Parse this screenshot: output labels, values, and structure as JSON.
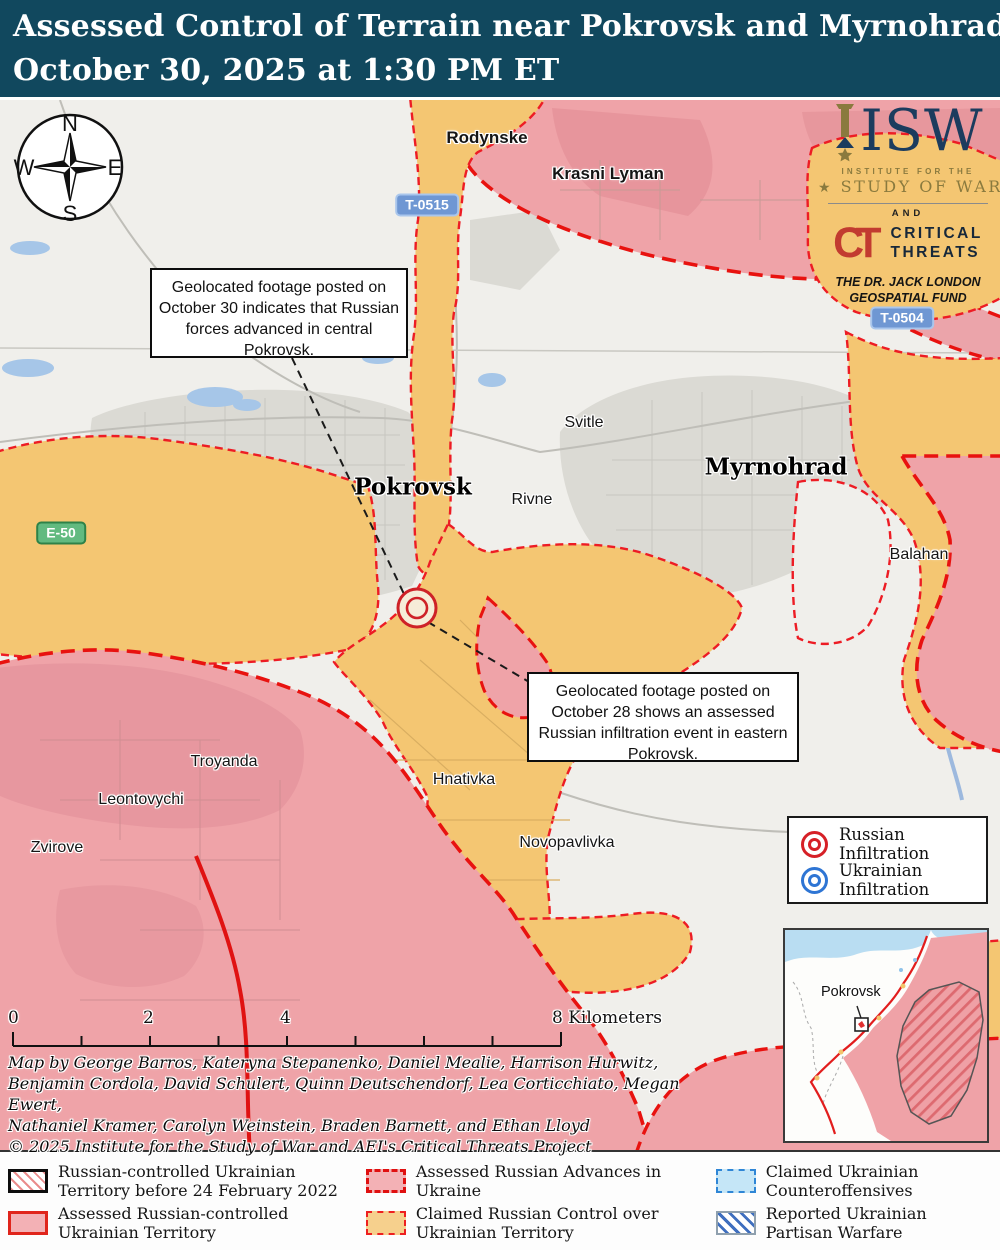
{
  "title": {
    "line1": "Assessed Control of Terrain near Pokrovsk and Myrnohrad",
    "line2": "October 30, 2025 at 1:30 PM ET"
  },
  "compass": {
    "n": "N",
    "e": "E",
    "s": "S",
    "w": "W"
  },
  "logo": {
    "isw": "ISW",
    "institute": "INSTITUTE FOR THE",
    "study": "STUDY OF WAR",
    "and": "AND",
    "ct": "CT",
    "critical": "CRITICAL",
    "threats": "THREATS",
    "fund_line1": "THE DR. JACK LONDON",
    "fund_line2": "GEOSPATIAL FUND"
  },
  "map": {
    "labels": {
      "rodynske": "Rodynske",
      "krasni_lyman": "Krasni Lyman",
      "svitle": "Svitle",
      "myrnohrad": "Myrnohrad",
      "pokrovsk": "Pokrovsk",
      "rivne": "Rivne",
      "balahan": "Balahan",
      "troyanda": "Troyanda",
      "leontovychi": "Leontovychi",
      "zvirove": "Zvirove",
      "hnativka": "Hnativka",
      "novopavlivka": "Novopavlivka"
    },
    "shields": {
      "t0515": "T-0515",
      "t0504": "T-0504",
      "e50": "E-50"
    },
    "callout1": "Geolocated footage posted on October 30 indicates that Russian forces advanced in central Pokrovsk.",
    "callout2": "Geolocated footage posted on October 28 shows an assessed Russian infiltration event in eastern Pokrovsk.",
    "infiltration_legend": {
      "russian": "Russian Infiltration",
      "ukrainian": "Ukrainian Infiltration"
    },
    "inset_label": "Pokrovsk",
    "scale": {
      "t0": "0",
      "t2": "2",
      "t4": "4",
      "t8": "8  Kilometers"
    },
    "credits": [
      "Map by George Barros, Kateryna Stepanenko, Daniel Mealie, Harrison Hurwitz,",
      "Benjamin Cordola, David Schulert, Quinn Deutschendorf, Lea Corticchiato, Megan Ewert,",
      "Nathaniel Kramer, Carolyn Weinstein, Braden Barnett, and Ethan Lloyd",
      "© 2025 Institute for the Study of War and AEI's Critical Threats Project"
    ]
  },
  "legend": {
    "items": [
      {
        "label": "Russian-controlled Ukrainian Territory before 24 February 2022"
      },
      {
        "label": "Assessed Russian-controlled Ukrainian Territory"
      },
      {
        "label": "Assessed Russian Advances in Ukraine"
      },
      {
        "label": "Claimed Russian Control over Ukrainian Territory"
      },
      {
        "label": "Claimed Ukrainian Counteroffensives"
      },
      {
        "label": "Reported Ukrainian Partisan Warfare"
      }
    ]
  },
  "colors": {
    "titlebar": "#11485e",
    "claimed_russian_yellow": "#f4c672",
    "assessed_russian_pink": "#efa3a8",
    "advance_dash_red": "#e8120f",
    "counteroffensive_blue": "#c5e6f7",
    "water_blue": "#a6c6e8"
  }
}
